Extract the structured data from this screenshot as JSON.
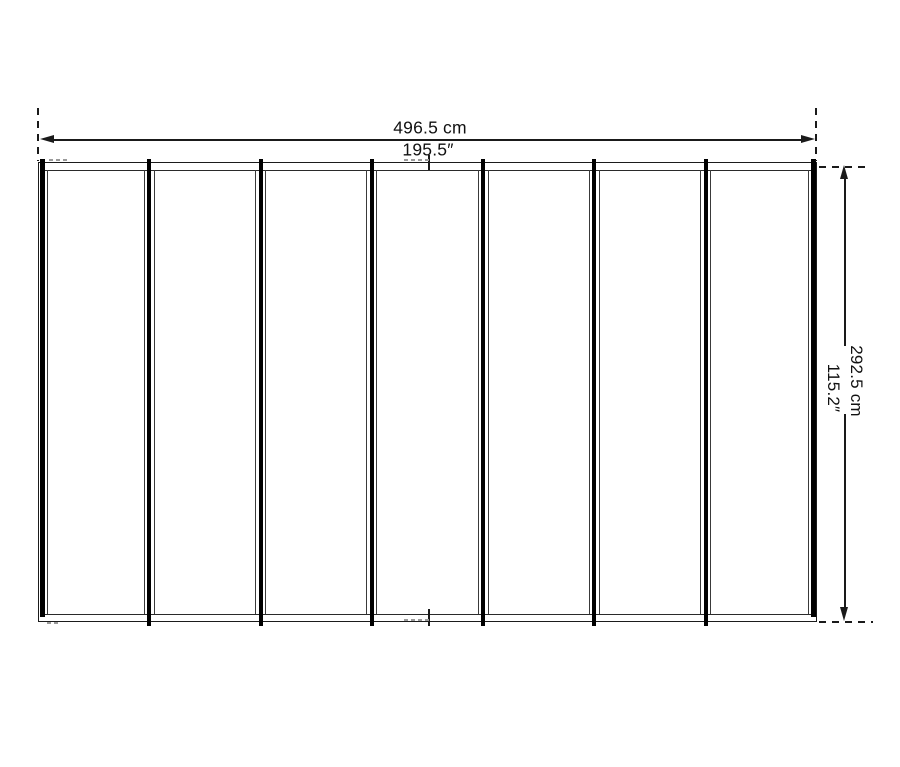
{
  "diagram": {
    "width_dimension": {
      "metric": "496.5 cm",
      "imperial": "195.5″"
    },
    "height_dimension": {
      "metric": "292.5 cm",
      "imperial": "115.2″"
    },
    "panel_count": 7,
    "colors": {
      "line": "#1a1a1a",
      "background": "#ffffff"
    }
  }
}
